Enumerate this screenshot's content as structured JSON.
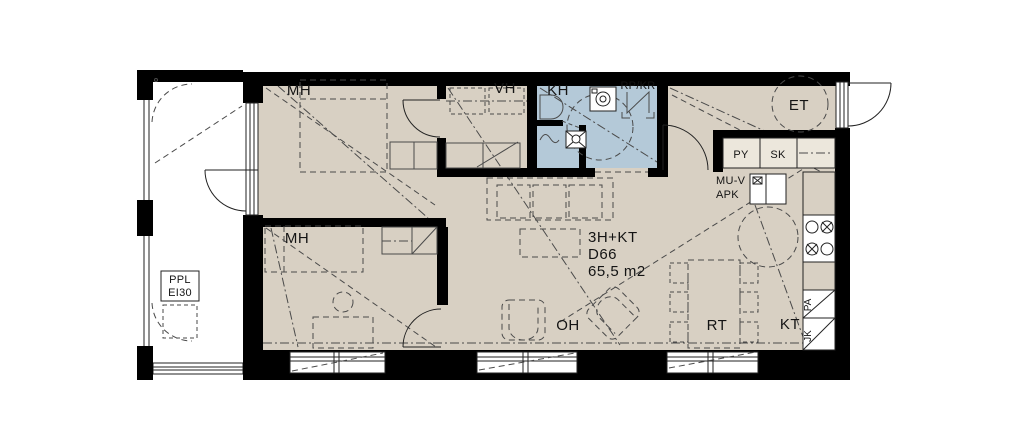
{
  "unit": {
    "layout": "3H+KT",
    "id": "D66",
    "area": "65,5 m2"
  },
  "rooms": {
    "mh1": "MH",
    "mh2": "MH",
    "vh": "VH",
    "kh": "KH",
    "et": "ET",
    "oh": "OH",
    "rt": "RT",
    "kt": "KT"
  },
  "fixtures": {
    "rp_kr": "RP/KR",
    "py": "PY",
    "sk": "SK",
    "mu_v": "MU-V",
    "apk": "APK",
    "pa": "PA",
    "jk": "JK"
  },
  "balcony": {
    "ppl": "PPL",
    "ei30": "EI30"
  },
  "colors": {
    "floor": "#d8d0c3",
    "wet_room": "#b4c9d8",
    "wall": "#000000",
    "line": "#3a3a3a"
  }
}
